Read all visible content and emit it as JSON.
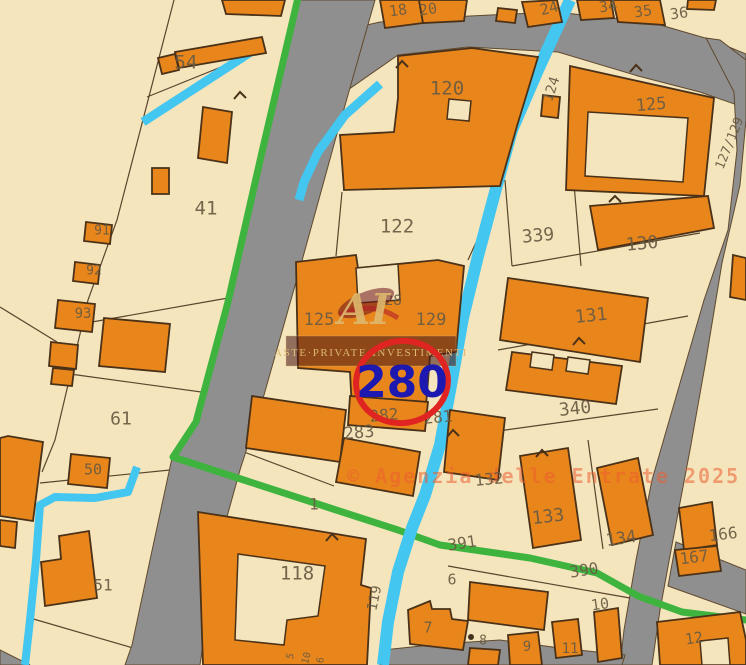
{
  "colors": {
    "parcel_fill": "#f4e5bd",
    "building_fill": "#e8861c",
    "road_fill": "#8f8f8f",
    "water": "#43c6ef",
    "boundary_green": "#3eb43e",
    "highlight_circle": "#e02421",
    "highlight_text": "#1c18b0",
    "label": "#6a5b43",
    "watermark_gold": "#dcb873",
    "copyright": "#ef6a3a"
  },
  "highlight": {
    "parcel": "280"
  },
  "watermark": {
    "banner": "ASTE·PRIVATE·INVESTIMENTI",
    "monogram": "AI"
  },
  "copyright": {
    "text": "© Agenzia delle Entrate 2025"
  },
  "map": {
    "labels": [
      {
        "t": "54",
        "x": 186,
        "y": 62,
        "s": 19,
        "r": 0
      },
      {
        "t": "41",
        "x": 206,
        "y": 208,
        "s": 19,
        "r": 0
      },
      {
        "t": "91",
        "x": 102,
        "y": 230,
        "s": 13,
        "r": 0
      },
      {
        "t": "92",
        "x": 94,
        "y": 270,
        "s": 13,
        "r": 0
      },
      {
        "t": "93",
        "x": 83,
        "y": 313,
        "s": 14,
        "r": 0
      },
      {
        "t": "61",
        "x": 121,
        "y": 418,
        "s": 18,
        "r": 0
      },
      {
        "t": "50",
        "x": 93,
        "y": 469,
        "s": 15,
        "r": 0
      },
      {
        "t": "51",
        "x": 103,
        "y": 585,
        "s": 16,
        "r": 0
      },
      {
        "t": "18",
        "x": 398,
        "y": 10,
        "s": 15,
        "r": -8
      },
      {
        "t": "20",
        "x": 428,
        "y": 9,
        "s": 15,
        "r": -8
      },
      {
        "t": "24",
        "x": 549,
        "y": 8,
        "s": 15,
        "r": -15
      },
      {
        "t": "34",
        "x": 608,
        "y": 6,
        "s": 15,
        "r": -8
      },
      {
        "t": "35",
        "x": 643,
        "y": 11,
        "s": 15,
        "r": -8
      },
      {
        "t": "36",
        "x": 679,
        "y": 13,
        "s": 15,
        "r": -8
      },
      {
        "t": "120",
        "x": 447,
        "y": 88,
        "s": 19,
        "r": 0
      },
      {
        "t": "122",
        "x": 397,
        "y": 226,
        "s": 19,
        "r": 0
      },
      {
        "t": "124",
        "x": 551,
        "y": 89,
        "s": 14,
        "r": -72
      },
      {
        "t": "125",
        "x": 651,
        "y": 104,
        "s": 17,
        "r": -5
      },
      {
        "t": "127/129",
        "x": 729,
        "y": 143,
        "s": 13,
        "r": -68
      },
      {
        "t": "339",
        "x": 538,
        "y": 235,
        "s": 18,
        "r": -5
      },
      {
        "t": "130",
        "x": 642,
        "y": 243,
        "s": 18,
        "r": -5
      },
      {
        "t": "125",
        "x": 319,
        "y": 319,
        "s": 17,
        "r": 0
      },
      {
        "t": "128",
        "x": 389,
        "y": 300,
        "s": 14,
        "r": 0
      },
      {
        "t": "129",
        "x": 431,
        "y": 319,
        "s": 17,
        "r": 0
      },
      {
        "t": "131",
        "x": 591,
        "y": 315,
        "s": 18,
        "r": -6
      },
      {
        "t": "340",
        "x": 575,
        "y": 408,
        "s": 18,
        "r": -6
      },
      {
        "t": "282",
        "x": 384,
        "y": 415,
        "s": 16,
        "r": -5
      },
      {
        "t": "281",
        "x": 438,
        "y": 417,
        "s": 16,
        "r": -5
      },
      {
        "t": "283",
        "x": 359,
        "y": 432,
        "s": 17,
        "r": -5
      },
      {
        "t": "132",
        "x": 489,
        "y": 479,
        "s": 16,
        "r": -5
      },
      {
        "t": "133",
        "x": 548,
        "y": 516,
        "s": 18,
        "r": -7
      },
      {
        "t": "134",
        "x": 621,
        "y": 538,
        "s": 17,
        "r": -8
      },
      {
        "t": "391",
        "x": 462,
        "y": 543,
        "s": 16,
        "r": -9
      },
      {
        "t": "390",
        "x": 584,
        "y": 570,
        "s": 16,
        "r": -9
      },
      {
        "t": "1",
        "x": 314,
        "y": 504,
        "s": 16,
        "r": 0
      },
      {
        "t": "118",
        "x": 297,
        "y": 573,
        "s": 19,
        "r": 0
      },
      {
        "t": "119",
        "x": 374,
        "y": 598,
        "s": 14,
        "r": -78
      },
      {
        "t": "166",
        "x": 723,
        "y": 534,
        "s": 16,
        "r": -7
      },
      {
        "t": "167",
        "x": 694,
        "y": 557,
        "s": 16,
        "r": -7
      },
      {
        "t": "6",
        "x": 452,
        "y": 579,
        "s": 15,
        "r": 0
      },
      {
        "t": "7",
        "x": 428,
        "y": 627,
        "s": 15,
        "r": 0
      },
      {
        "t": "8",
        "x": 483,
        "y": 640,
        "s": 13,
        "r": 0
      },
      {
        "t": "9",
        "x": 527,
        "y": 646,
        "s": 14,
        "r": 0
      },
      {
        "t": "10",
        "x": 600,
        "y": 604,
        "s": 15,
        "r": -8
      },
      {
        "t": "11",
        "x": 570,
        "y": 648,
        "s": 14,
        "r": 0
      },
      {
        "t": "12",
        "x": 694,
        "y": 638,
        "s": 15,
        "r": -8
      },
      {
        "t": "5",
        "x": 290,
        "y": 656,
        "s": 10,
        "r": -75
      },
      {
        "t": "10",
        "x": 306,
        "y": 658,
        "s": 10,
        "r": -75
      },
      {
        "t": "6",
        "x": 320,
        "y": 660,
        "s": 10,
        "r": -75
      }
    ]
  }
}
